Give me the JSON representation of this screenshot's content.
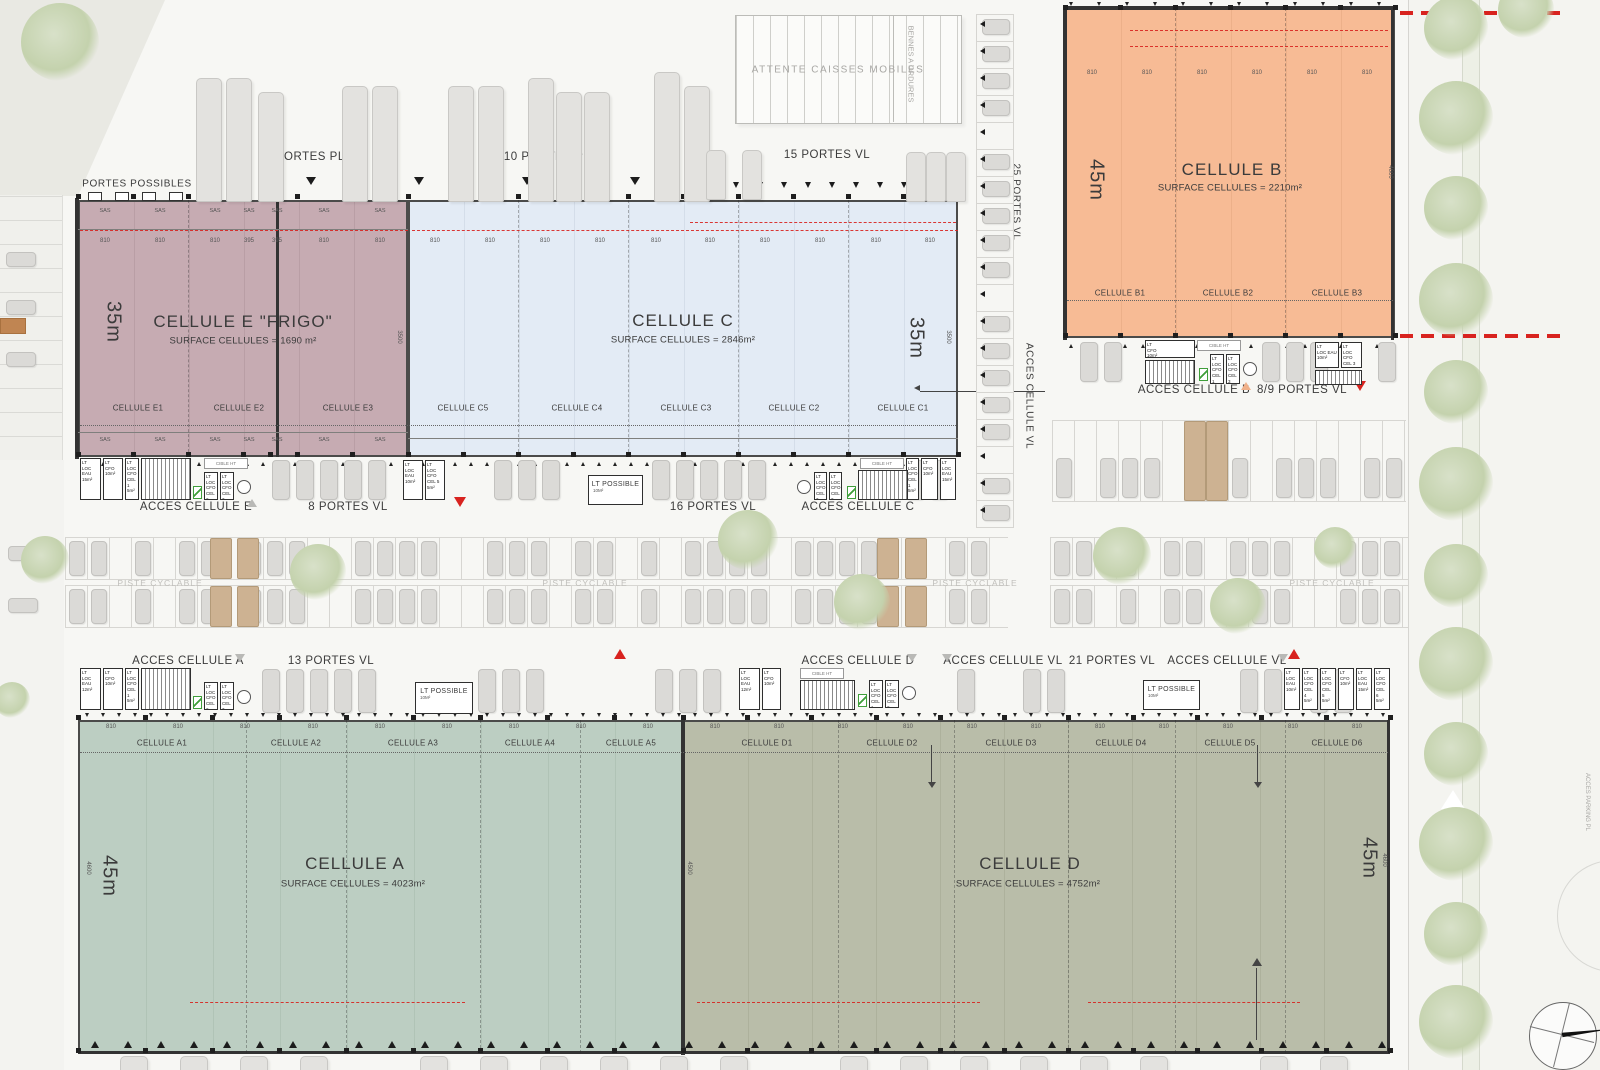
{
  "cells": {
    "e": {
      "title": "CELLULE E \"FRIGO\"",
      "surface": "SURFACE CELLULES = 1690 m²",
      "depth": "35m",
      "subcells": [
        "CELLULE E1",
        "CELLULE E2",
        "CELLULE E3"
      ],
      "dims": [
        "810",
        "810",
        "810",
        "395",
        "395",
        "810",
        "810"
      ],
      "sas": "SAS"
    },
    "c": {
      "title": "CELLULE C",
      "surface": "SURFACE CELLULES = 2846m²",
      "depth": "35m",
      "subcells": [
        "CELLULE C5",
        "CELLULE C4",
        "CELLULE C3",
        "CELLULE C2",
        "CELLULE C1"
      ],
      "dims": [
        "810",
        "810",
        "810",
        "810",
        "810",
        "810",
        "810",
        "810",
        "810",
        "810"
      ]
    },
    "b": {
      "title": "CELLULE B",
      "surface": "SURFACE CELLULES = 2210m²",
      "depth": "45m",
      "subcells": [
        "CELLULE B1",
        "CELLULE B2",
        "CELLULE B3"
      ],
      "dims": [
        "810",
        "810",
        "810",
        "810",
        "810",
        "810"
      ]
    },
    "a": {
      "title": "CELLULE A",
      "surface": "SURFACE CELLULES = 4023m²",
      "depth": "45m",
      "subcells": [
        "CELLULE A1",
        "CELLULE A2",
        "CELLULE A3",
        "CELLULE A4",
        "CELLULE A5"
      ],
      "dims": [
        "810",
        "810",
        "810",
        "810",
        "810",
        "810",
        "810",
        "810",
        "810"
      ]
    },
    "d": {
      "title": "CELLULE D",
      "surface": "SURFACE CELLULES = 4752m²",
      "depth": "45m",
      "subcells": [
        "CELLULE D1",
        "CELLULE D2",
        "CELLULE D3",
        "CELLULE D4",
        "CELLULE D5",
        "CELLULE D6"
      ],
      "dims": [
        "810",
        "810",
        "810",
        "810",
        "810",
        "810",
        "810",
        "810",
        "810",
        "810",
        "810"
      ]
    }
  },
  "labels": {
    "portes_possibles": "PORTES POSSIBLES",
    "six_portes_pl": "6 PORTES PL",
    "dix_portes_pl": "10 PORTES PL",
    "quinze_portes_vl": "15 PORTES VL",
    "vingtcinq_portes_vl": "25 PORTES VL",
    "acces_cellule_vl": "ACCES CELLULE VL",
    "attente_caisses": "ATTENTE CAISSES MOBILES",
    "bennes_ordures": "BENNES A ORDURES",
    "acces_cellule_e": "ACCES CELLULE E",
    "huit_portes_vl": "8 PORTES VL",
    "seize_portes_vl": "16 PORTES VL",
    "acces_cellule_c": "ACCES CELLULE C",
    "acces_cellule_b": "ACCES CELLULE B",
    "huit_neuf_portes_vl": "8/9 PORTES VL",
    "piste_cyclable": "PISTE CYCLABLE",
    "acces_cellule_a": "ACCES CELLULE A",
    "treize_portes_vl": "13 PORTES VL",
    "acces_cellule_d": "ACCES CELLULE D",
    "vingtetun_portes_vl": "21 PORTES VL",
    "acces_parking_pl": "ACCES PARKING PL",
    "lt_possible": "LT POSSIBLE",
    "lt_possible_sub": "10M²",
    "cible_ht": "CIBLE HT"
  },
  "dims": {
    "d3500": "3500",
    "d4500": "4500",
    "d4600": "4600"
  },
  "lt": {
    "lt": "LT",
    "eau15": "LOC EAU\n15m²",
    "eau12": "LOC EAU\n12m²",
    "eau10": "LOC EAU\n10m²",
    "cfo10": "CFO\n10m²",
    "cel1": "LOC CFO\nCEL 1\n5m²",
    "cel2": "LOC CFO\nCEL 2\n5m²",
    "cel3": "LOC CFO\nCEL 3\n5m²",
    "cel4": "LOC CFO\nCEL 4\n5m²",
    "cel5": "LOC CFO\nCEL 5\n5m²",
    "cel6": "LOC CFO\nCEL 6\n5m²"
  },
  "colors": {
    "cell_e": "#c6abb2",
    "cell_c": "#e3ebf5",
    "cell_b": "#f7bb95",
    "cell_a": "#bccec2",
    "cell_d": "#b9bda9",
    "red": "#d8231f",
    "peach": "#f0b089"
  }
}
